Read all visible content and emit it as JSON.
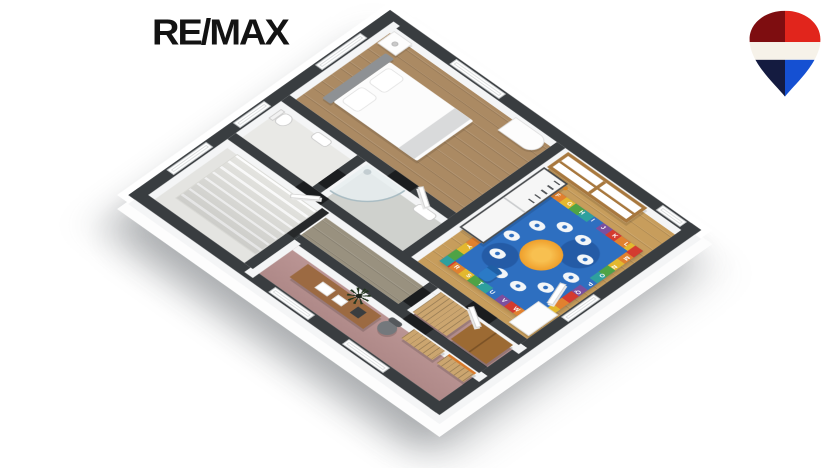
{
  "brand": {
    "logo_text": "RE/MAX",
    "balloon_icon": "remax-balloon",
    "balloon_colors": {
      "top_left": "#7E0D10",
      "top_right": "#E1251C",
      "band": "#F6F2E9",
      "bottom_left": "#141B40",
      "bottom_right": "#1550D2"
    }
  },
  "floorplan": {
    "type": "3d-isometric-floor-plan",
    "wall_top_color": "#393D40",
    "rooms": [
      {
        "name": "bedroom",
        "floor_color": "#AB8A63",
        "furniture": [
          "double-bed",
          "headboard",
          "pillows",
          "nightstand",
          "dresser"
        ]
      },
      {
        "name": "kids-room",
        "floor_color": "#C79D5C",
        "furniture": [
          "bunk-bed",
          "panel-wardrobe",
          "alphabet-rug",
          "kid-chair",
          "white-desk",
          "toy"
        ]
      },
      {
        "name": "wc",
        "floor_color": "#E9E9E6",
        "furniture": [
          "toilet",
          "sink"
        ]
      },
      {
        "name": "bathroom",
        "floor_color": "#CFD1CD",
        "furniture": [
          "corner-shower",
          "washbasin"
        ]
      },
      {
        "name": "stair-hall",
        "floor_color": "#E4E4E1",
        "furniture": [
          "staircase"
        ]
      },
      {
        "name": "corridor",
        "floor_color": "#99917F",
        "furniture": [
          "doors"
        ]
      },
      {
        "name": "dressing-room",
        "floor_color": "#B8908F",
        "furniture": [
          "slatted-cabinet",
          "wooden-wardrobe"
        ]
      },
      {
        "name": "office",
        "floor_color": "#B8908F",
        "furniture": [
          "desk",
          "office-chair",
          "shelving-unit",
          "shelving-unit",
          "dark-plant"
        ]
      }
    ],
    "rug": {
      "style": "alphabet-play-rug",
      "field_color": "#2E6FC0",
      "sun_color": "#EE9B27",
      "border_colors": [
        "#D43B2F",
        "#E1812F",
        "#E3B82F",
        "#4FA345",
        "#2EA09E",
        "#2F6FC0",
        "#7B4F9E"
      ],
      "letters": {
        "north": "F G H I J K L",
        "east": "M N O P Q",
        "south": "R S T U V W",
        "west": "E D C B A Z Y"
      }
    }
  }
}
